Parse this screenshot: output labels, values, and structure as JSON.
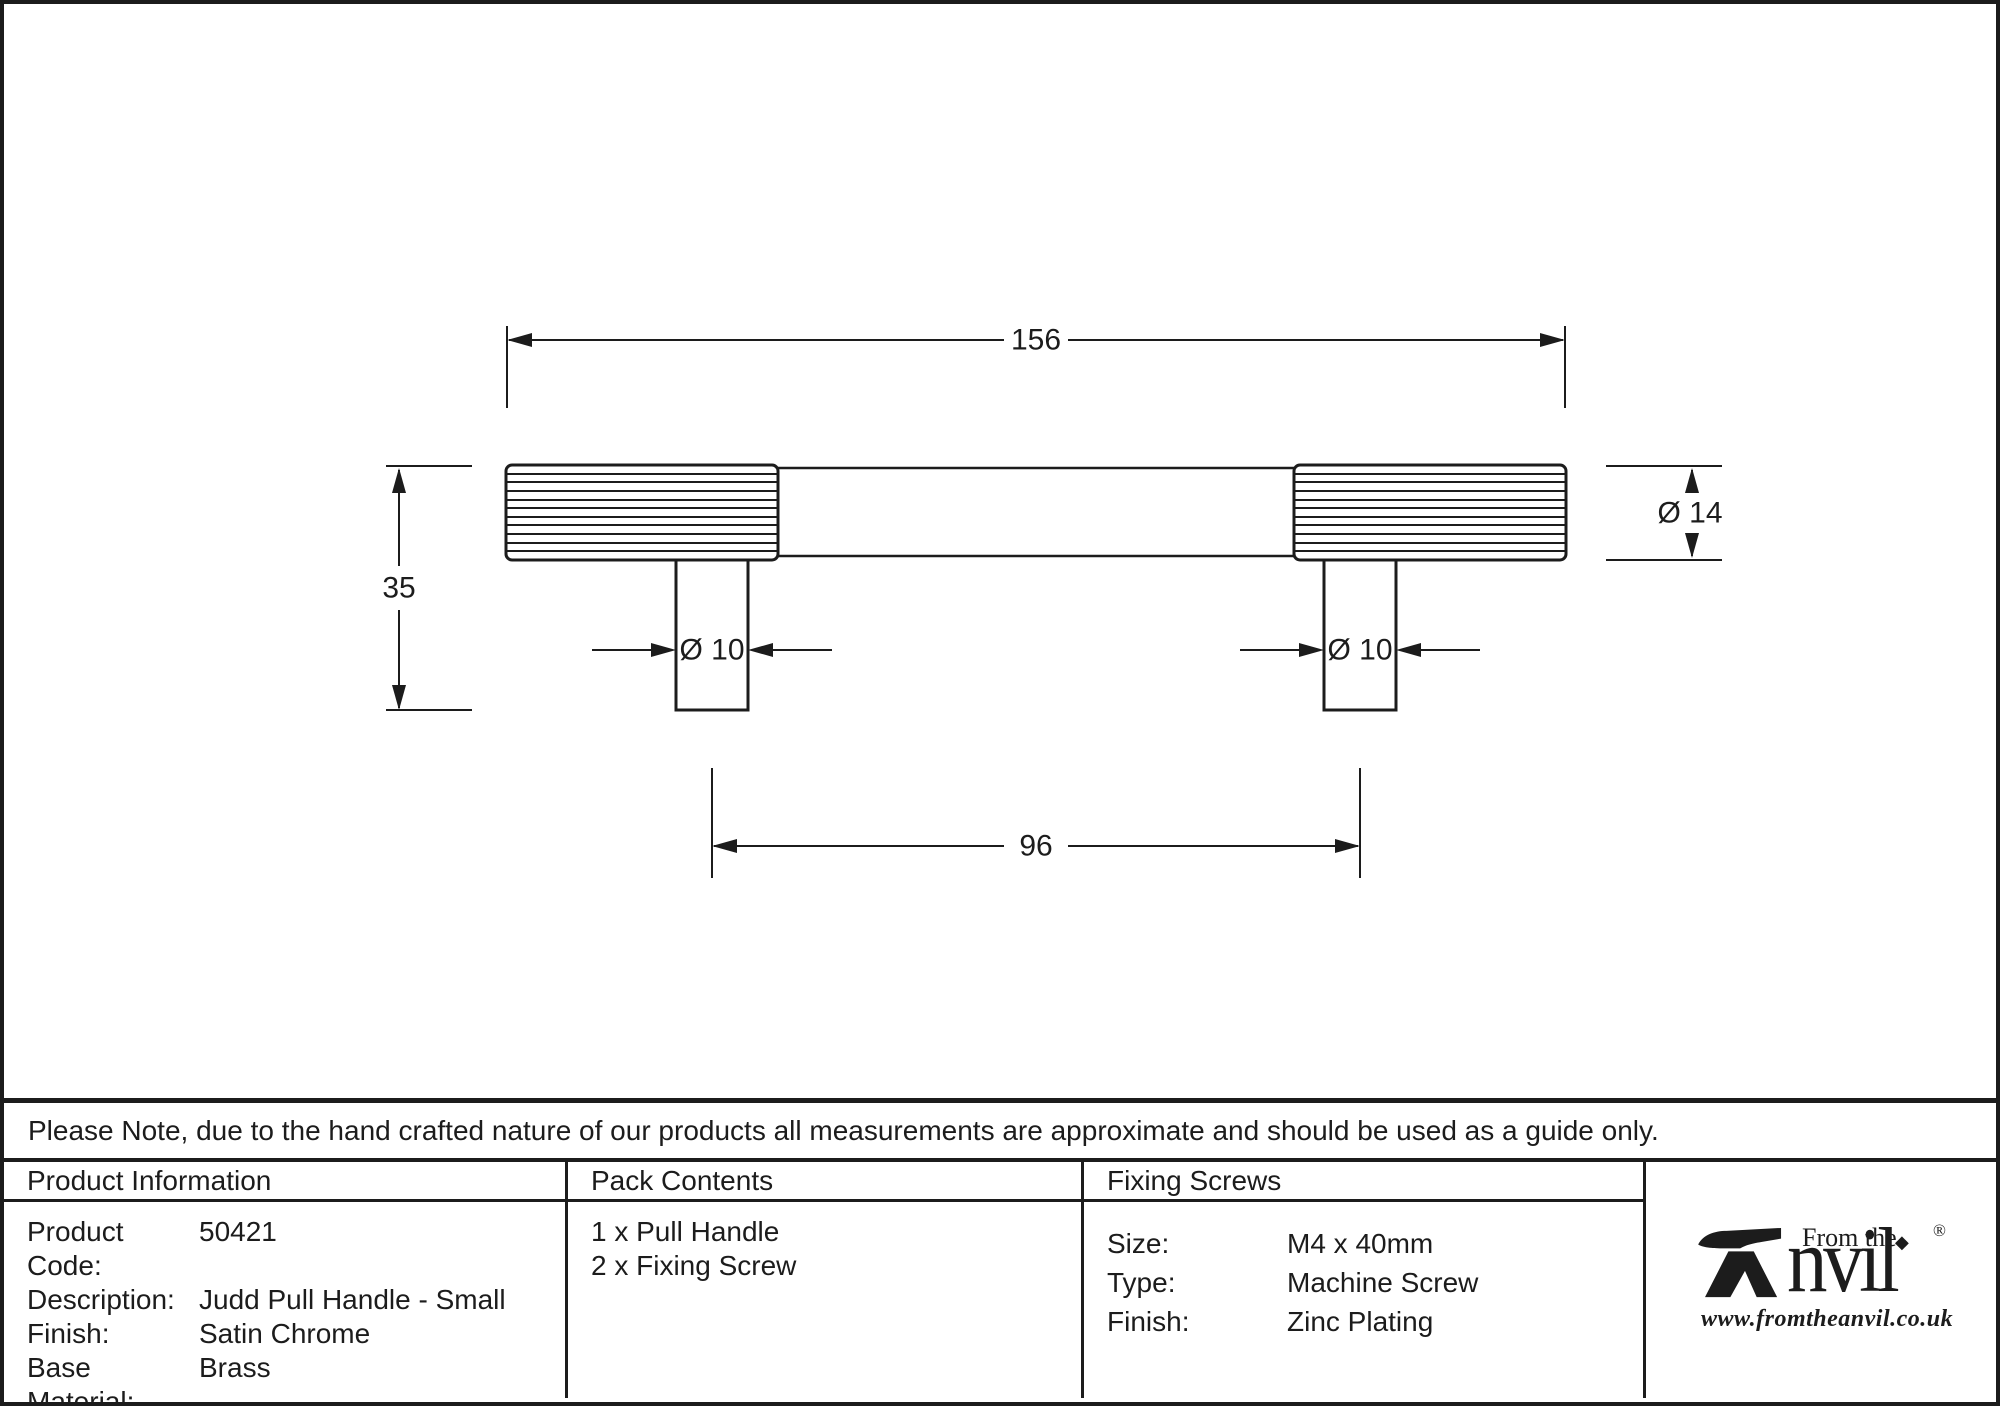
{
  "drawing": {
    "dim_length_total": "156",
    "dim_height": "35",
    "dim_hole_centres": "96",
    "dim_post_diameter_left": "Ø 10",
    "dim_post_diameter_right": "Ø 10",
    "dim_handle_diameter": "Ø 14"
  },
  "note": {
    "text": "Please Note, due to the hand crafted nature of our products all measurements are approximate and should be used as a guide only."
  },
  "table": {
    "product_information": {
      "header": "Product Information",
      "rows": [
        {
          "label": "Product Code:",
          "value": "50421"
        },
        {
          "label": "Description:",
          "value": "Judd Pull Handle - Small"
        },
        {
          "label": "Finish:",
          "value": "Satin Chrome"
        },
        {
          "label": "Base Material:",
          "value": "Brass"
        }
      ]
    },
    "pack_contents": {
      "header": "Pack Contents",
      "items": [
        "1 x Pull Handle",
        "2 x Fixing Screw"
      ]
    },
    "fixing_screws": {
      "header": "Fixing Screws",
      "rows": [
        {
          "label": "Size:",
          "value": "M4 x 40mm"
        },
        {
          "label": "Type:",
          "value": "Machine Screw"
        },
        {
          "label": "Finish:",
          "value": "Zinc Plating"
        }
      ]
    }
  },
  "logo": {
    "tagline": "From the",
    "brand": "nvil",
    "registered": "®",
    "website": "www.fromtheanvil.co.uk"
  },
  "icons": {
    "diamond": "◆"
  },
  "colors": {
    "ink": "#1c1c1c",
    "background": "#ffffff"
  }
}
